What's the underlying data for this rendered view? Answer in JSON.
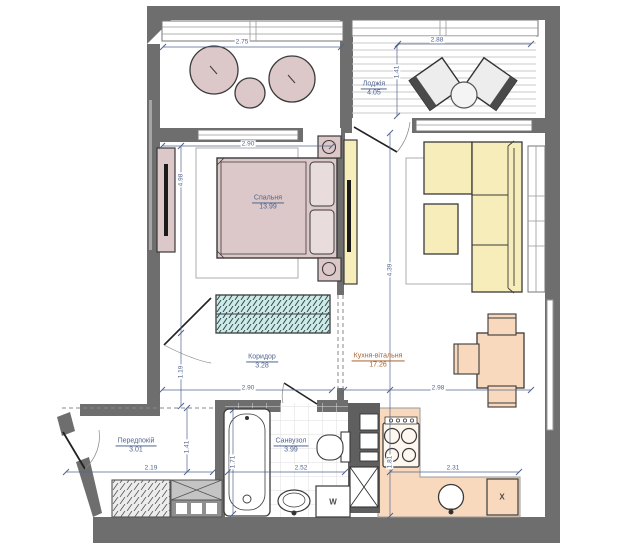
{
  "rooms": [
    {
      "name": "Спальня",
      "area": "13.99"
    },
    {
      "name": "Коридор",
      "area": "3.28"
    },
    {
      "name": "Кухня-вітальня",
      "area": "17.26"
    },
    {
      "name": "Лоджія",
      "area": "4.05"
    },
    {
      "name": "Передпокій",
      "area": "3.01"
    },
    {
      "name": "Санвузол",
      "area": "3.99"
    }
  ],
  "dimensions": {
    "balcony_width": "2.75",
    "loggia_width": "2.88",
    "loggia_depth": "1.41",
    "bedroom_width": "2.90",
    "bedroom_length": "4.98",
    "corridor_depth": "1.19",
    "corridor_width": "2.90",
    "living_length": "4.39",
    "living_width": "2.98",
    "kitchen_run": "2.31",
    "kitchen_depth": "1.81",
    "hall_width": "2.19",
    "hall_depth": "1.41",
    "bath_width": "2.52",
    "bathtub_length": "1.71"
  },
  "labels": {
    "washing_machine": "W",
    "fridge_box": "X"
  },
  "colors": {
    "wall": "#6e6e6e",
    "bedroom_pink": "#dcc8c8",
    "sofa_yellow": "#f7edbb",
    "kitchen_peach": "#f9d9bd",
    "wardrobe_teal": "#cdeae8",
    "dimension_text": "#51658f",
    "kitchen_label_text": "#a8622e"
  }
}
